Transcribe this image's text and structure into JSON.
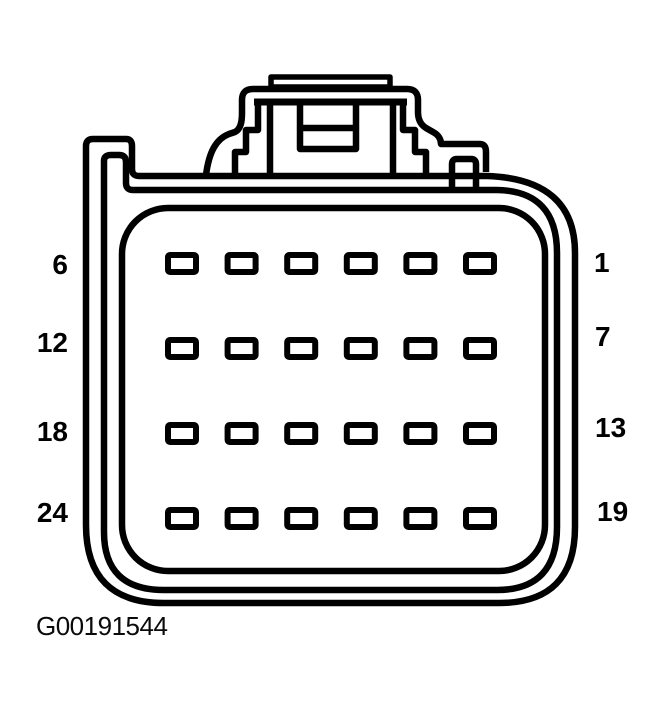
{
  "diagram": {
    "caption": "G00191544",
    "grid": {
      "rows": 4,
      "cols": 6
    },
    "pin_labels": {
      "left": [
        "6",
        "12",
        "18",
        "24"
      ],
      "right": [
        "1",
        "7",
        "13",
        "19"
      ]
    },
    "colors": {
      "line": "#000000",
      "background": "#ffffff"
    }
  }
}
